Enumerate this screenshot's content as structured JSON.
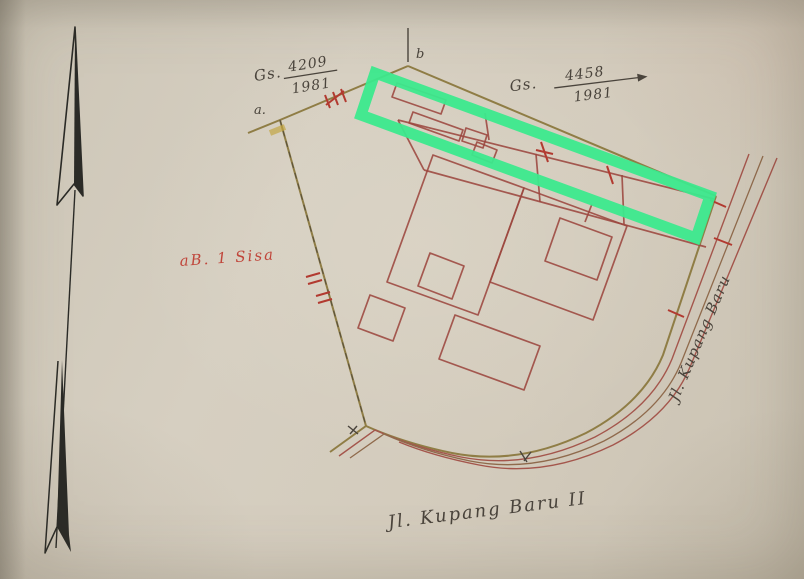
{
  "map": {
    "description_visible_text_only": "",
    "labels": {
      "cert_left": {
        "prefix": "Gs.",
        "numerator": "4209",
        "denominator": "1981"
      },
      "cert_right": {
        "prefix": "Gs.",
        "numerator": "4458",
        "denominator": "1981"
      },
      "remainder": {
        "text": "aB. 1 Sisa"
      },
      "road_right": {
        "text": "Jl. Kupang Baru"
      },
      "road_bottom": {
        "text": "Jl. Kupang Baru II"
      },
      "points": {
        "a": "a.",
        "b": "b",
        "x": "x"
      }
    },
    "icons": {
      "north_arrow": "north-arrow-icon"
    },
    "colors": {
      "highlight": "#3ce98d",
      "boundary": "#8f7d45",
      "boundary-dash": "#5a523d",
      "building": "#9c473f",
      "road-red": "#a4564c",
      "road-brown": "#8f6a4c",
      "mark-red": "#b23a30",
      "label-red": "#c0453a",
      "ink": "#4a443c",
      "arrow": "#2b2b27"
    }
  }
}
